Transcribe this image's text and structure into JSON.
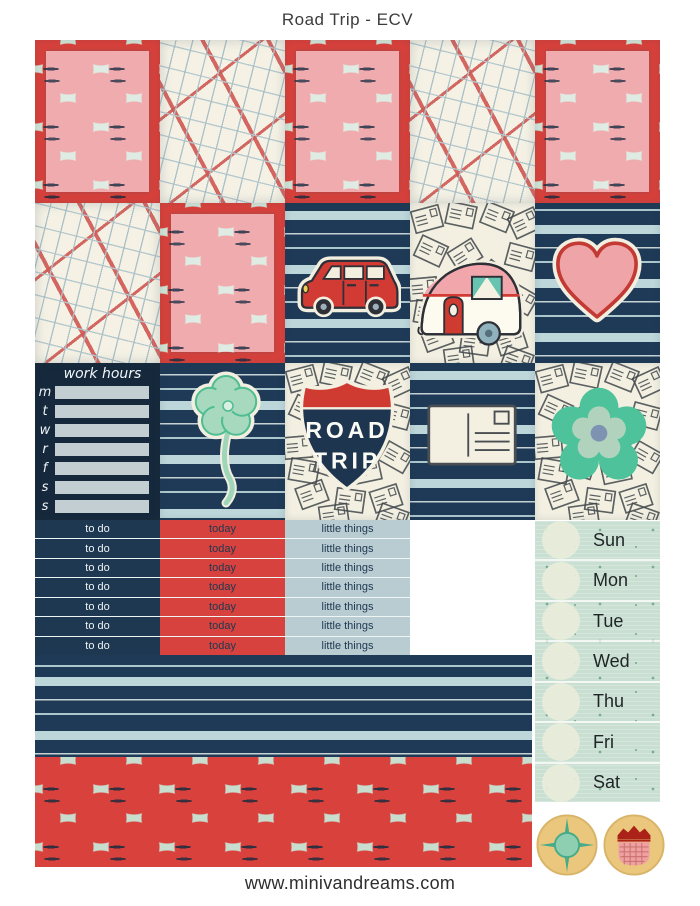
{
  "page": {
    "title": "Road Trip - ECV",
    "footer": "www.minivandreams.com"
  },
  "work_hours": {
    "title": "work hours",
    "day_letters": [
      "m",
      "t",
      "w",
      "r",
      "f",
      "s",
      "s"
    ]
  },
  "road_trip_sign": {
    "line1": "ROAD",
    "line2": "TRIP"
  },
  "strips": {
    "rows": [
      {
        "todo": "to do",
        "today": "today",
        "little": "little things"
      },
      {
        "todo": "to do",
        "today": "today",
        "little": "little things"
      },
      {
        "todo": "to do",
        "today": "today",
        "little": "little things"
      },
      {
        "todo": "to do",
        "today": "today",
        "little": "little things"
      },
      {
        "todo": "to do",
        "today": "today",
        "little": "little things"
      },
      {
        "todo": "to do",
        "today": "today",
        "little": "little things"
      },
      {
        "todo": "to do",
        "today": "today",
        "little": "little things"
      }
    ]
  },
  "days": {
    "labels": [
      "Sun",
      "Mon",
      "Tue",
      "Wed",
      "Thu",
      "Fri",
      "Sat"
    ]
  },
  "stickers": {
    "icons": [
      "map-pattern",
      "polka-dots",
      "red-car",
      "camper-trailer",
      "heart",
      "mint-flower",
      "road-trip-shield",
      "postcard",
      "teal-flower",
      "compass-star",
      "picnic-basket"
    ]
  },
  "colors": {
    "navy": "#1e3a57",
    "red": "#d8413c",
    "pink": "#efa9ac",
    "mint": "#cfe3d6",
    "light_blue": "#bcd6da",
    "cream": "#f3efe1",
    "gold": "#eac77c",
    "teal": "#4ec29a"
  }
}
